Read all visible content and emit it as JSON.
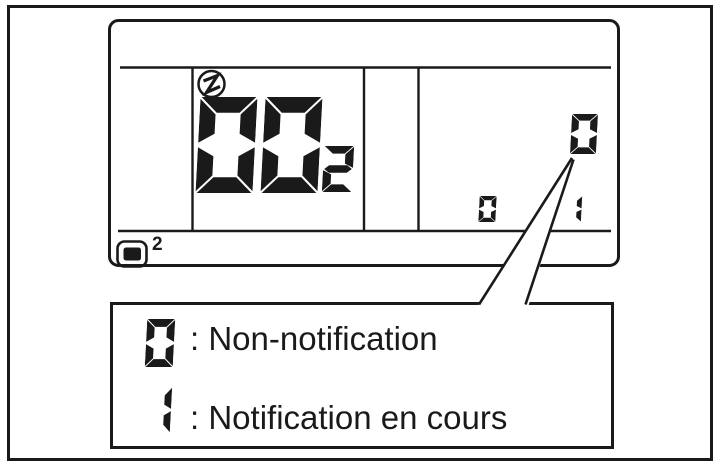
{
  "figure": {
    "description": "remote-controller-lcd-notification-diagram"
  },
  "display": {
    "centralized_control_icon": "circled-zigzag-icon",
    "unit_display_icon": "rounded-screen-icon",
    "unit_display_count": "2",
    "unit_number": {
      "digits": [
        "0",
        "0"
      ],
      "subscript_digit": "2"
    },
    "notification_status_digit": "0",
    "small_left_digit": "0",
    "small_right_digit": "1"
  },
  "legend": {
    "items": [
      {
        "digit": "0",
        "text": ": Non-notification"
      },
      {
        "digit": "1",
        "text": ": Notification en cours"
      }
    ]
  },
  "colors": {
    "ink": "#1a1a1a",
    "background": "#ffffff"
  }
}
